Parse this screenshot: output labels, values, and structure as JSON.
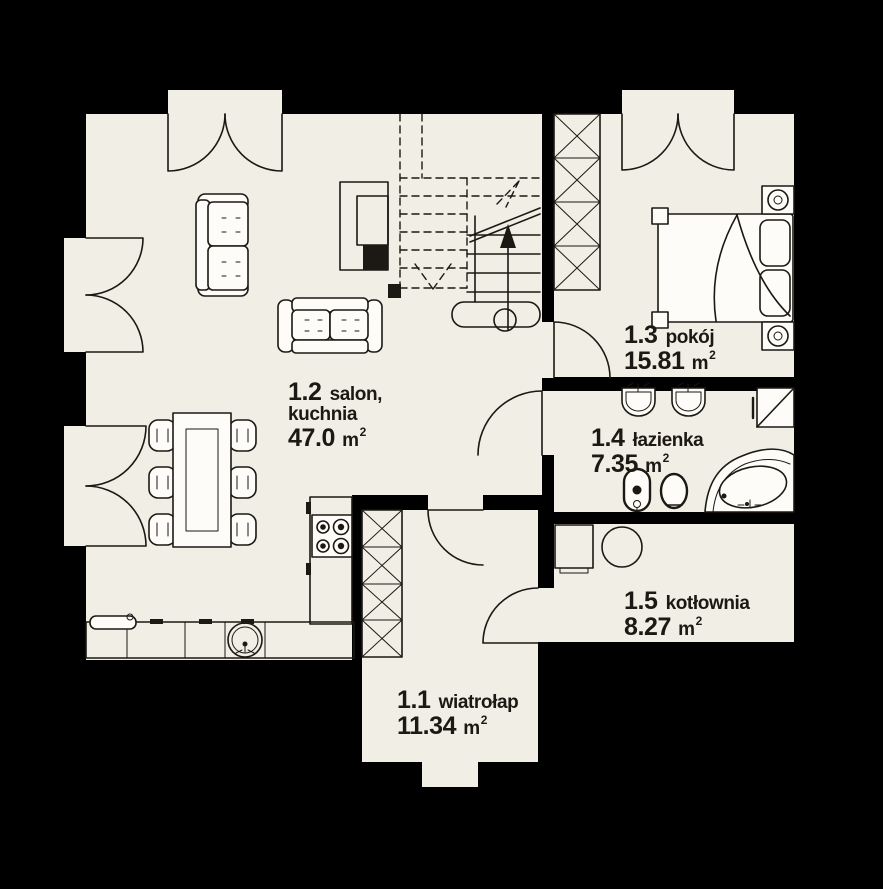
{
  "colors": {
    "bg": "#000000",
    "floor": "#f1eee5",
    "fixture": "#fdfcf8",
    "line": "#1c1813"
  },
  "rooms": [
    {
      "number": "1.1",
      "name": "wiatrołap",
      "area_value": "11.34",
      "area_unit": "m",
      "area_sup": "2"
    },
    {
      "number": "1.2",
      "name": "salon,",
      "name_line2": "kuchnia",
      "area_value": "47.0",
      "area_unit": "m",
      "area_sup": "2"
    },
    {
      "number": "1.3",
      "name": "pokój",
      "area_value": "15.81",
      "area_unit": "m",
      "area_sup": "2"
    },
    {
      "number": "1.4",
      "name": "łazienka",
      "area_value": "7.35",
      "area_unit": "m",
      "area_sup": "2"
    },
    {
      "number": "1.5",
      "name": "kotłownia",
      "area_value": "8.27",
      "area_unit": "m",
      "area_sup": "2"
    }
  ],
  "furniture_icons": [
    "sofa",
    "fireplace",
    "dining-table",
    "chair",
    "stairs",
    "kitchen-counter",
    "kitchen-sink",
    "stove",
    "bed",
    "nightstand",
    "lamp",
    "washbasin",
    "shower",
    "bidet",
    "toilet",
    "corner-bathtub",
    "boiler",
    "water-tank",
    "chimney-shaft",
    "door-swing"
  ]
}
